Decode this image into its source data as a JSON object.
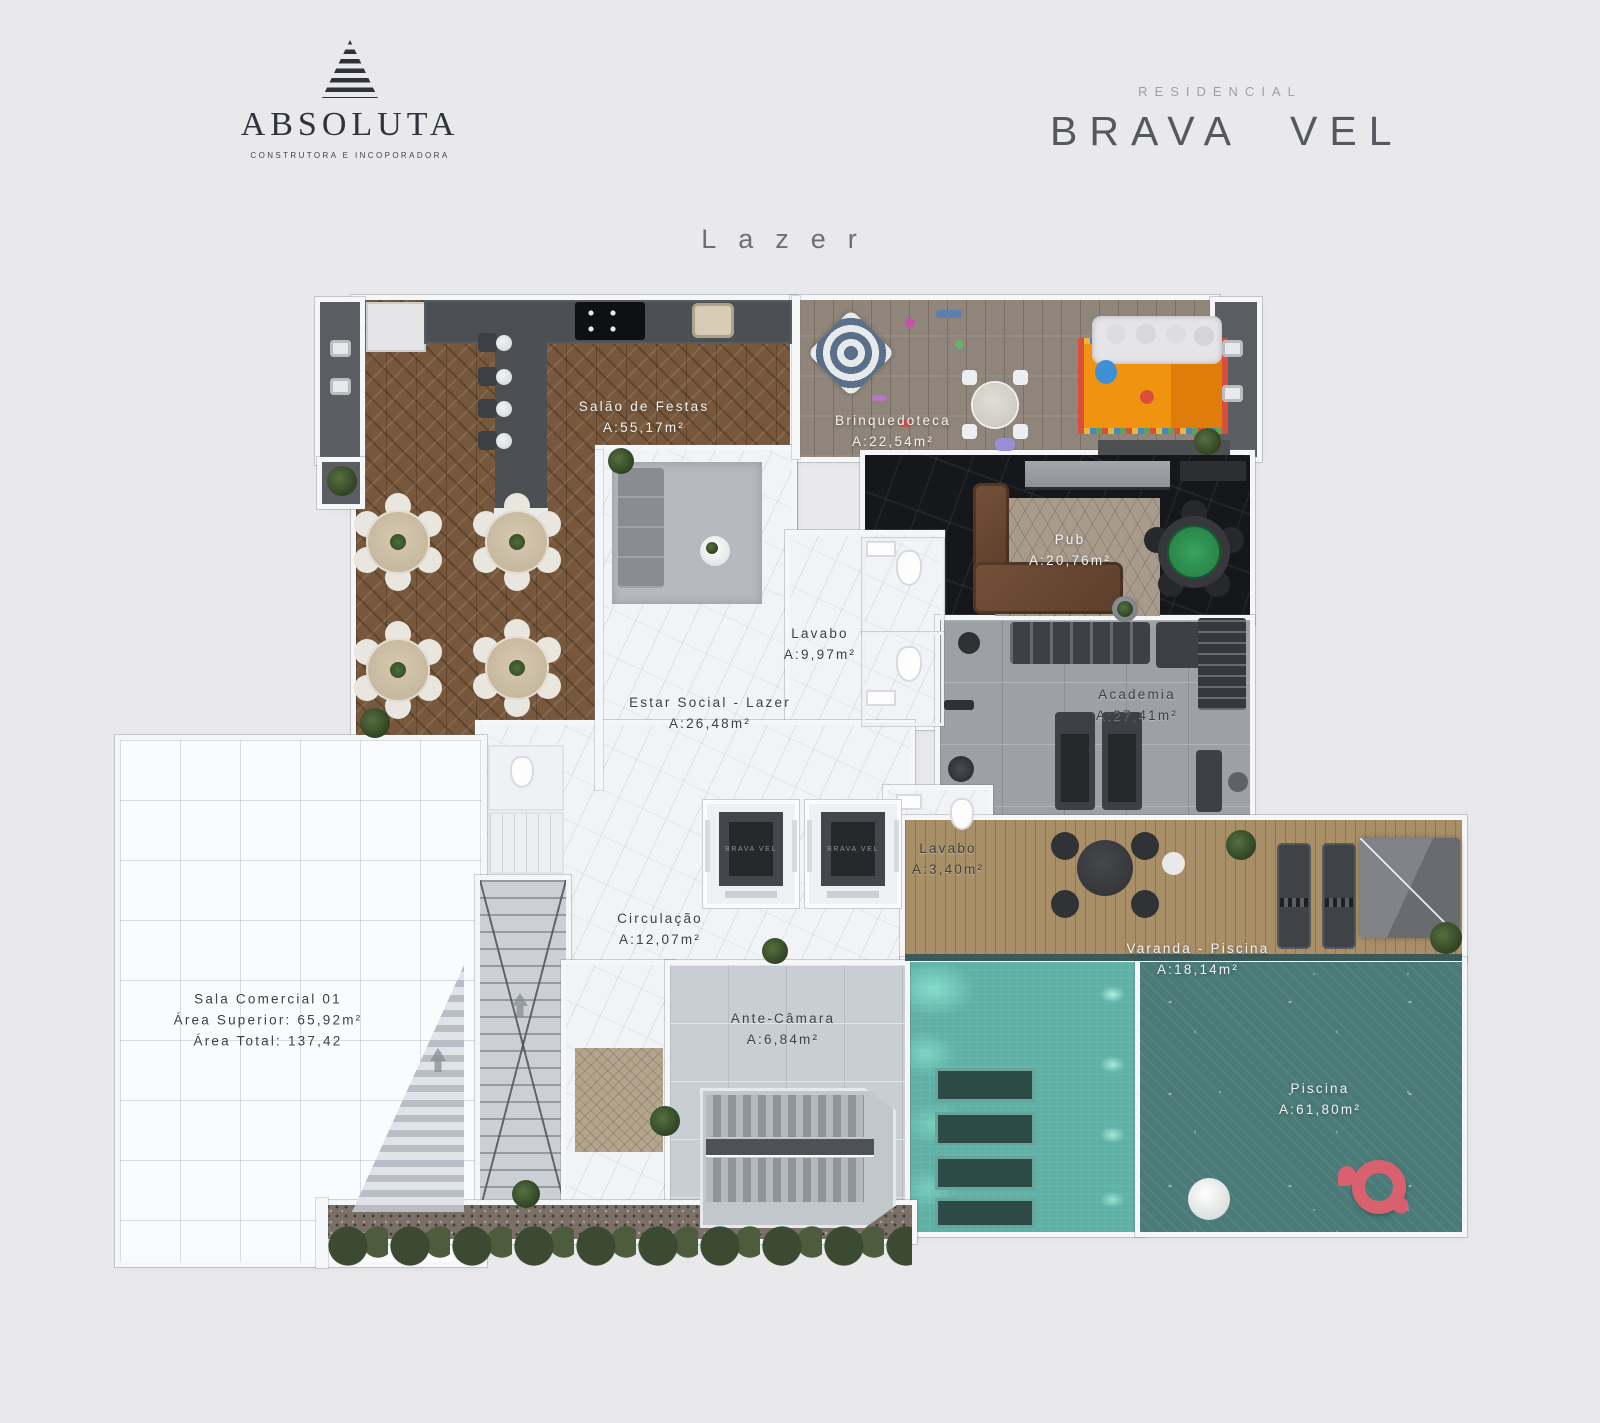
{
  "header": {
    "builder": {
      "name": "ABSOLUTA",
      "tagline": "CONSTRUTORA E INCOPORADORA"
    },
    "project": {
      "kicker": "RESIDENCIAL",
      "name": "BRAVA VEL"
    }
  },
  "plan": {
    "title": "Lazer",
    "elevator_label": "BRAVA VEL",
    "rooms": [
      {
        "id": "salao-de-festas",
        "name": "Salão de Festas",
        "area": "A:55,17m²"
      },
      {
        "id": "brinquedoteca",
        "name": "Brinquedoteca",
        "area": "A:22,54m²"
      },
      {
        "id": "pub",
        "name": "Pub",
        "area": "A:20,76m²"
      },
      {
        "id": "lavabo-social",
        "name": "Lavabo",
        "area": "A:9,97m²"
      },
      {
        "id": "estar-social",
        "name": "Estar Social - Lazer",
        "area": "A:26,48m²"
      },
      {
        "id": "academia",
        "name": "Academia",
        "area": "A:27,41m²"
      },
      {
        "id": "lavabo-pequeno",
        "name": "Lavabo",
        "area": "A:3,40m²"
      },
      {
        "id": "circulacao",
        "name": "Circulação",
        "area": "A:12,07m²"
      },
      {
        "id": "varanda-piscina",
        "name": "Varanda - Piscina",
        "area": "A:18,14m²"
      },
      {
        "id": "sala-comercial",
        "name": "Sala Comercial 01",
        "area_superior": "Área Superior: 65,92m²",
        "area_total": "Área Total: 137,42"
      },
      {
        "id": "ante-camara",
        "name": "Ante-Câmara",
        "area": "A:6,84m²"
      },
      {
        "id": "piscina",
        "name": "Piscina",
        "area": "A:61,80m²"
      }
    ],
    "colors": {
      "background": "#e9e9eb",
      "wood_party_room": "#77583d",
      "wood_playroom": "#90857a",
      "pub_floor": "#16171b",
      "pool_shallow": "#5fb0a6",
      "pool_deep": "#4a7b78",
      "deck": "#a98f68",
      "kids_rug": "#f0930f",
      "flamingo_float": "#d9606f",
      "poker_felt": "#2e8b50",
      "walls": "#f5f6f8"
    }
  }
}
